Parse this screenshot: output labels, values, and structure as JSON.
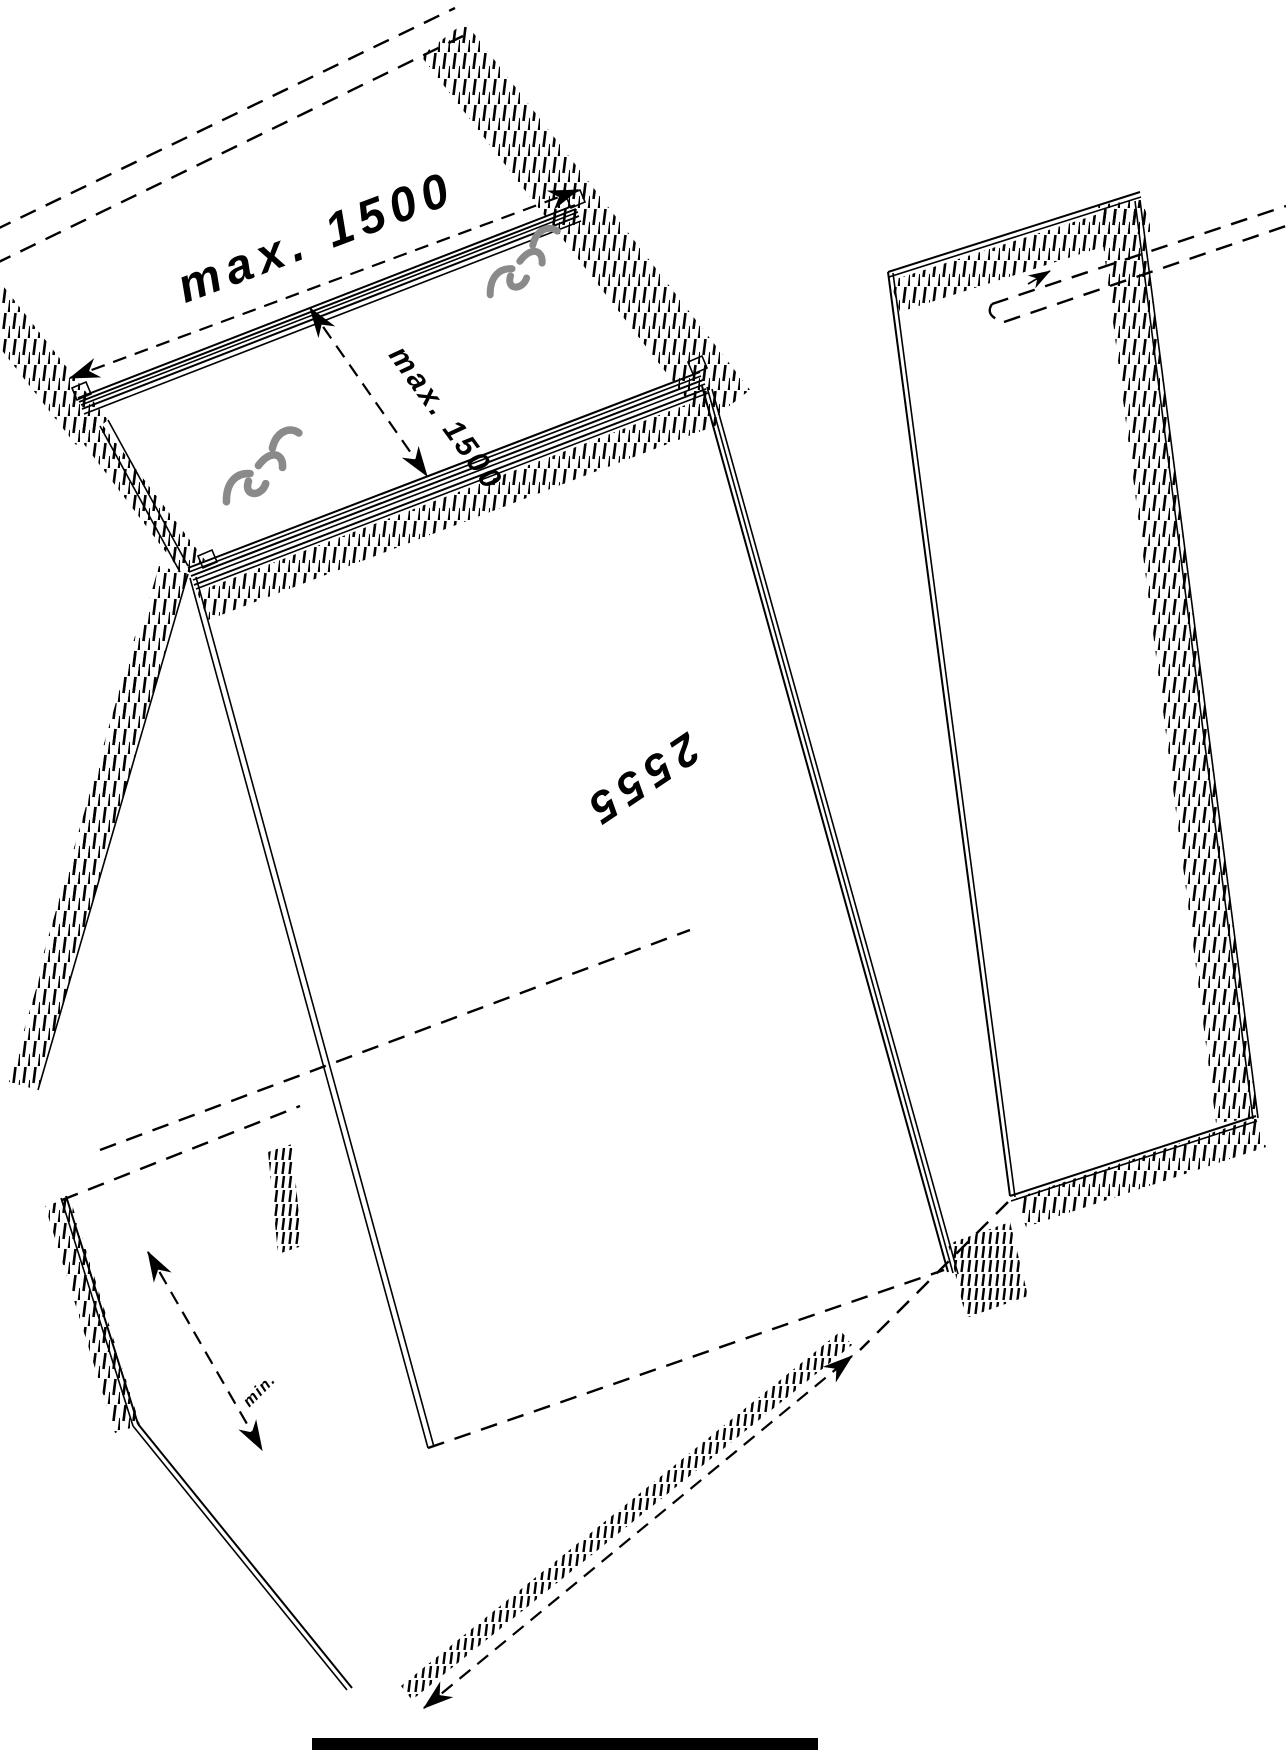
{
  "drawing": {
    "labels": {
      "dim_rail_spacing_top": "max. 1500",
      "dim_rail_spacing_side": "max. 1500",
      "dim_length": "2555",
      "dim_min": "min."
    },
    "colors": {
      "line": "#000000",
      "background": "#ffffff",
      "clip": "#8a8a8a",
      "bottom_bar": "#000000"
    },
    "icons": {
      "arrowhead": "arrowhead-icon",
      "clip_upper": "mounting-clip-icon",
      "clip_lower": "mounting-clip-icon"
    }
  }
}
